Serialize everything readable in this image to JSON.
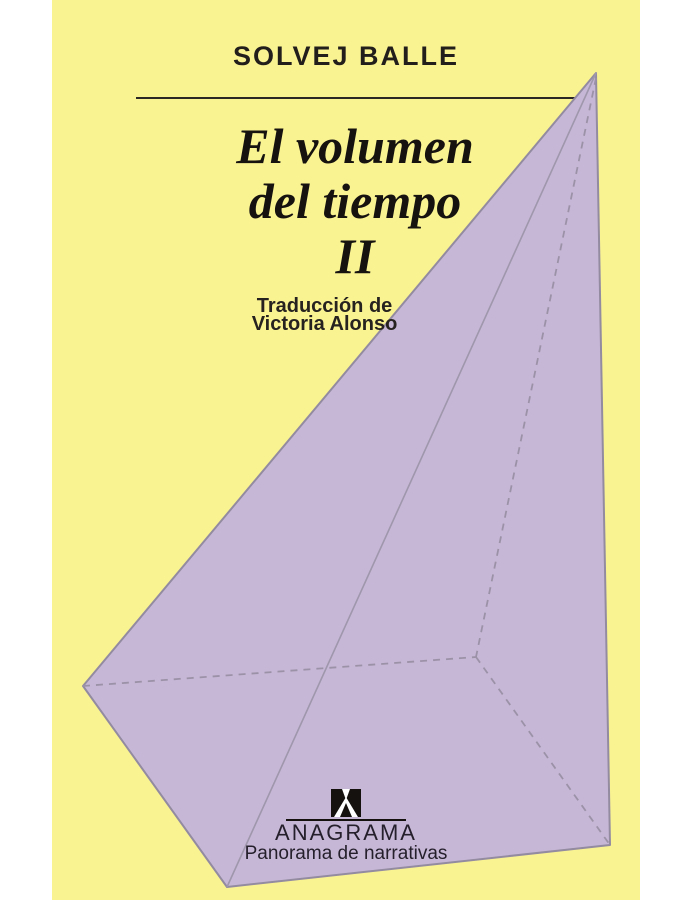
{
  "cover": {
    "author": "SOLVEJ BALLE",
    "title_lines": [
      "El volumen",
      "del tiempo",
      "II"
    ],
    "translation_lines": [
      "Traducción de",
      "Victoria Alonso"
    ],
    "publisher": {
      "logo_icon": "anagrama-a-icon",
      "name": "ANAGRAMA",
      "imprint": "Panorama de narrativas"
    },
    "artwork": {
      "description": "tall lavender pyramid with dashed hidden edges",
      "colors": {
        "page_white": "#FFFFFF",
        "cover_yellow": "#FAF392",
        "pyramid_lavender": "#C6B7D6",
        "edge_gray": "#938BA0",
        "dashed_edge_gray": "#9C92A8",
        "text_black": "#1C1916"
      }
    }
  }
}
